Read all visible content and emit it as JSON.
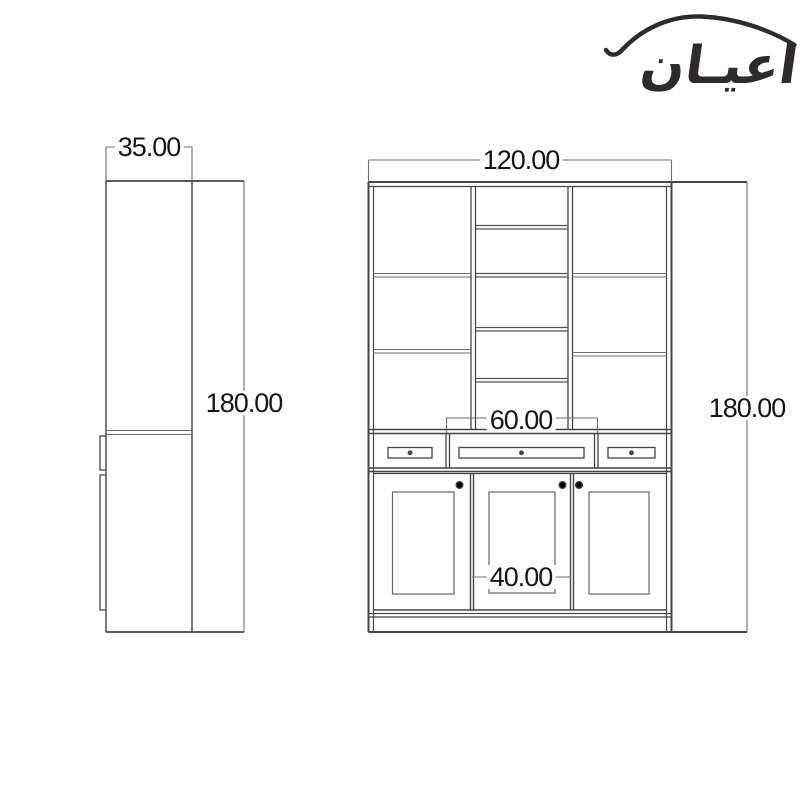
{
  "logo": {
    "text": "اعيـان",
    "color": "#2e2b2a",
    "swoosh_icon": "arc-swoosh"
  },
  "drawing": {
    "background": "#ffffff",
    "line_color": "#454545",
    "thin_line_color": "#6f6f6f",
    "views": {
      "side": {
        "title": "cabinet-side-view",
        "width_label": "35.00",
        "height_label": "180.00"
      },
      "front": {
        "title": "cabinet-front-view",
        "width_label": "120.00",
        "height_label": "180.00",
        "center_drawer_width_label": "60.00",
        "center_door_width_label": "40.00"
      }
    }
  }
}
